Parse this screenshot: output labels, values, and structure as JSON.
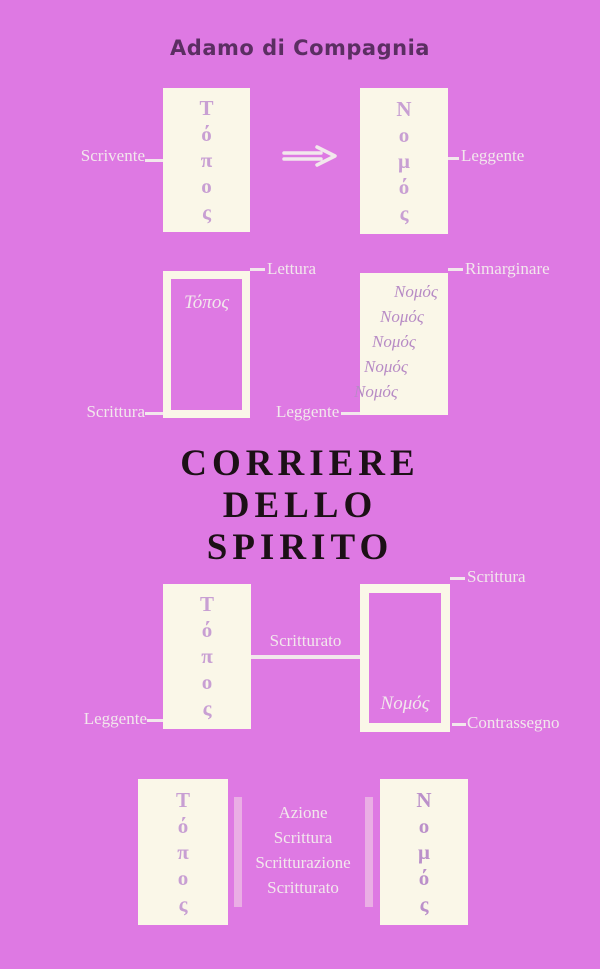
{
  "cover": {
    "author": "Adamo di Compagnia",
    "title_lines": [
      "CORRIERE",
      "DELLO",
      "SPIRITO"
    ]
  },
  "colors": {
    "background": "#de79e3",
    "box_fill": "#faf7e8",
    "greek_letters": "#c89fd3",
    "greek_words": "#b78bc5",
    "label_text": "#f2e7ec",
    "title_text": "#1c1016",
    "author_text": "#5b2e62"
  },
  "diagram1": {
    "left_label": "Scrivente",
    "right_label": "Leggente",
    "left_letters": [
      "Τ",
      "ό",
      "π",
      "ο",
      "ς"
    ],
    "right_letters": [
      "Ν",
      "ο",
      "μ",
      "ό",
      "ς"
    ],
    "arrow_icon": "double-right-arrow"
  },
  "diagram2": {
    "top_left_label": "Lettura",
    "top_right_label": "Rimarginare",
    "bottom_left_label": "Scrittura",
    "bottom_right_label": "Leggente",
    "left_box_word": "Τόπος",
    "right_box_words": [
      "Νομός",
      "Νομός",
      "Νομός",
      "Νομός",
      "Νομός"
    ]
  },
  "diagram3": {
    "middle_label": "Scritturato",
    "top_right_label": "Scrittura",
    "bottom_left_label": "Leggente",
    "bottom_right_label": "Contrassegno",
    "left_letters": [
      "Τ",
      "ό",
      "π",
      "ο",
      "ς"
    ],
    "right_box_word": "Νομός"
  },
  "diagram4": {
    "center_lines": [
      "Azione",
      "Scrittura",
      "Scritturazione",
      "Scritturato"
    ],
    "left_letters": [
      "Τ",
      "ό",
      "π",
      "ο",
      "ς"
    ],
    "right_letters": [
      "Ν",
      "ο",
      "μ",
      "ό",
      "ς"
    ]
  }
}
